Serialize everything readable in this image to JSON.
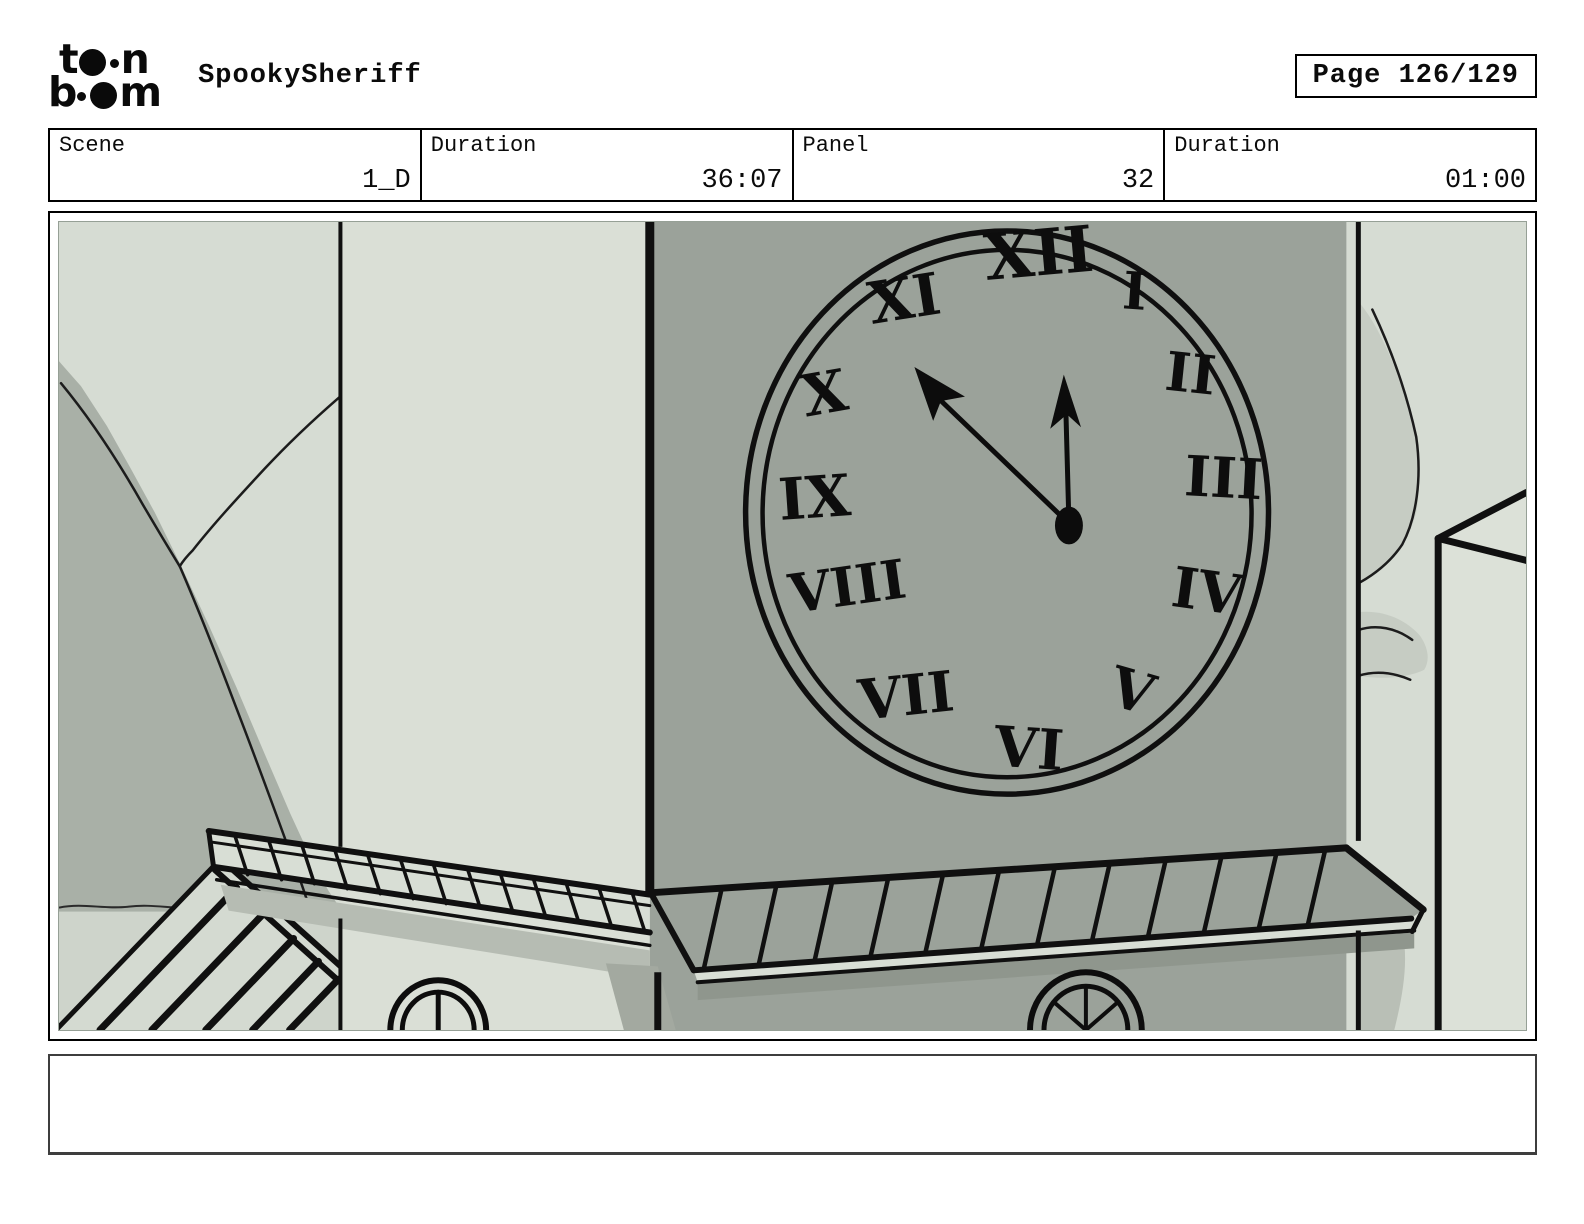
{
  "header": {
    "logo": {
      "line1_letter1": "t",
      "line1_letter2": "n",
      "line2_letter1": "b",
      "line2_letter2": "m"
    },
    "title": "SpookySheriff",
    "page_label": "Page 126/129"
  },
  "info_row": [
    {
      "label": "Scene",
      "value": "1_D"
    },
    {
      "label": "Duration",
      "value": "36:07"
    },
    {
      "label": "Panel",
      "value": "32"
    },
    {
      "label": "Duration",
      "value": "01:00"
    }
  ],
  "panel": {
    "description": "Hand-drawn clock tower corner with roman-numeral clock face, roof ledges and distant mountains",
    "clock": {
      "numerals": [
        "XII",
        "I",
        "II",
        "III",
        "IV",
        "V",
        "VI",
        "VII",
        "VIII",
        "IX",
        "X",
        "XI"
      ],
      "hour_hand_points_to": "XII",
      "minute_hand_points_to": "between X and XI"
    },
    "caption": ""
  },
  "colors": {
    "background_sage": "#d6dcd3",
    "tower_left_face": "#dadfd6",
    "tower_front_face": "#9ba29a",
    "mountain_dark": "#a9b0a7",
    "mountain_wash": "#c6ccc3",
    "ground": "#ced4cb",
    "shadow": "#b6bcb3",
    "ink": "#101010"
  }
}
